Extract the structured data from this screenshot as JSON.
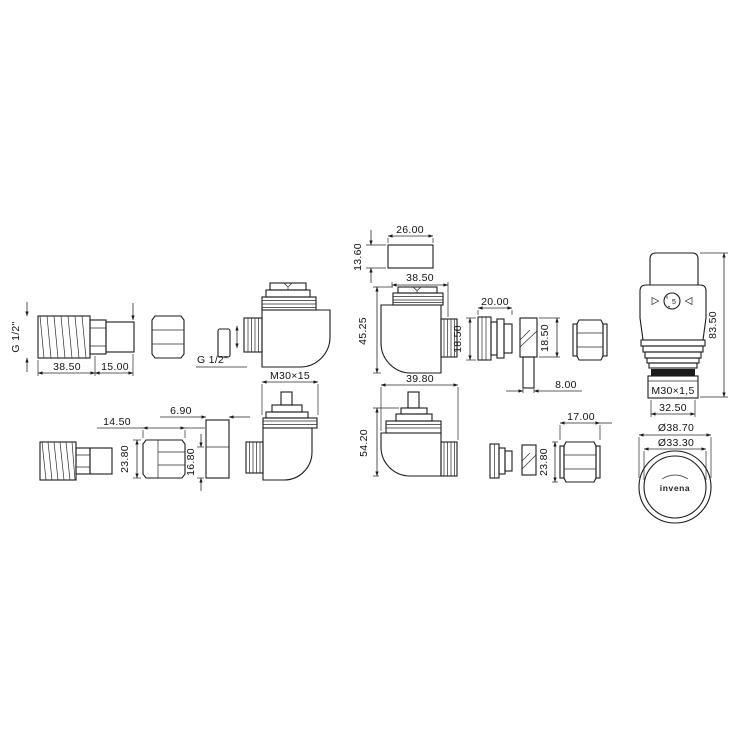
{
  "colors": {
    "line": "#1b1b1b",
    "background": "#ffffff"
  },
  "labels": {
    "g12_top": "G 1/2\"",
    "dim_tail_thread_len": "38.50",
    "dim_tail_plain_len": "15.00",
    "g12_mid": "G 1/2\"",
    "valve_insert_thread": "M30×15",
    "adapter_width": "26.00",
    "adapter_height": "13.60",
    "valve_mid_width": "38.50",
    "valve_mid_height": "45.25",
    "olive_width": "20.00",
    "olive_height": "18.50",
    "insert_height": "18.50",
    "insert_width": "8.00",
    "head_height": "83.50",
    "head_thread": "M30×1,5",
    "head_width": "32.50",
    "head_outer_dia": "Ø38.70",
    "head_inner_dia": "Ø33.30",
    "head_logo": "invena",
    "head_dial": "5",
    "nut_bl_width": "14.50",
    "nut_bl_height": "23.80",
    "spacer_width": "6.90",
    "spacer_height": "16.80",
    "valve_bot_width": "39.80",
    "valve_bot_height": "54.20",
    "nut_bot_width": "17.00",
    "nut_bot_height": "23.80"
  }
}
